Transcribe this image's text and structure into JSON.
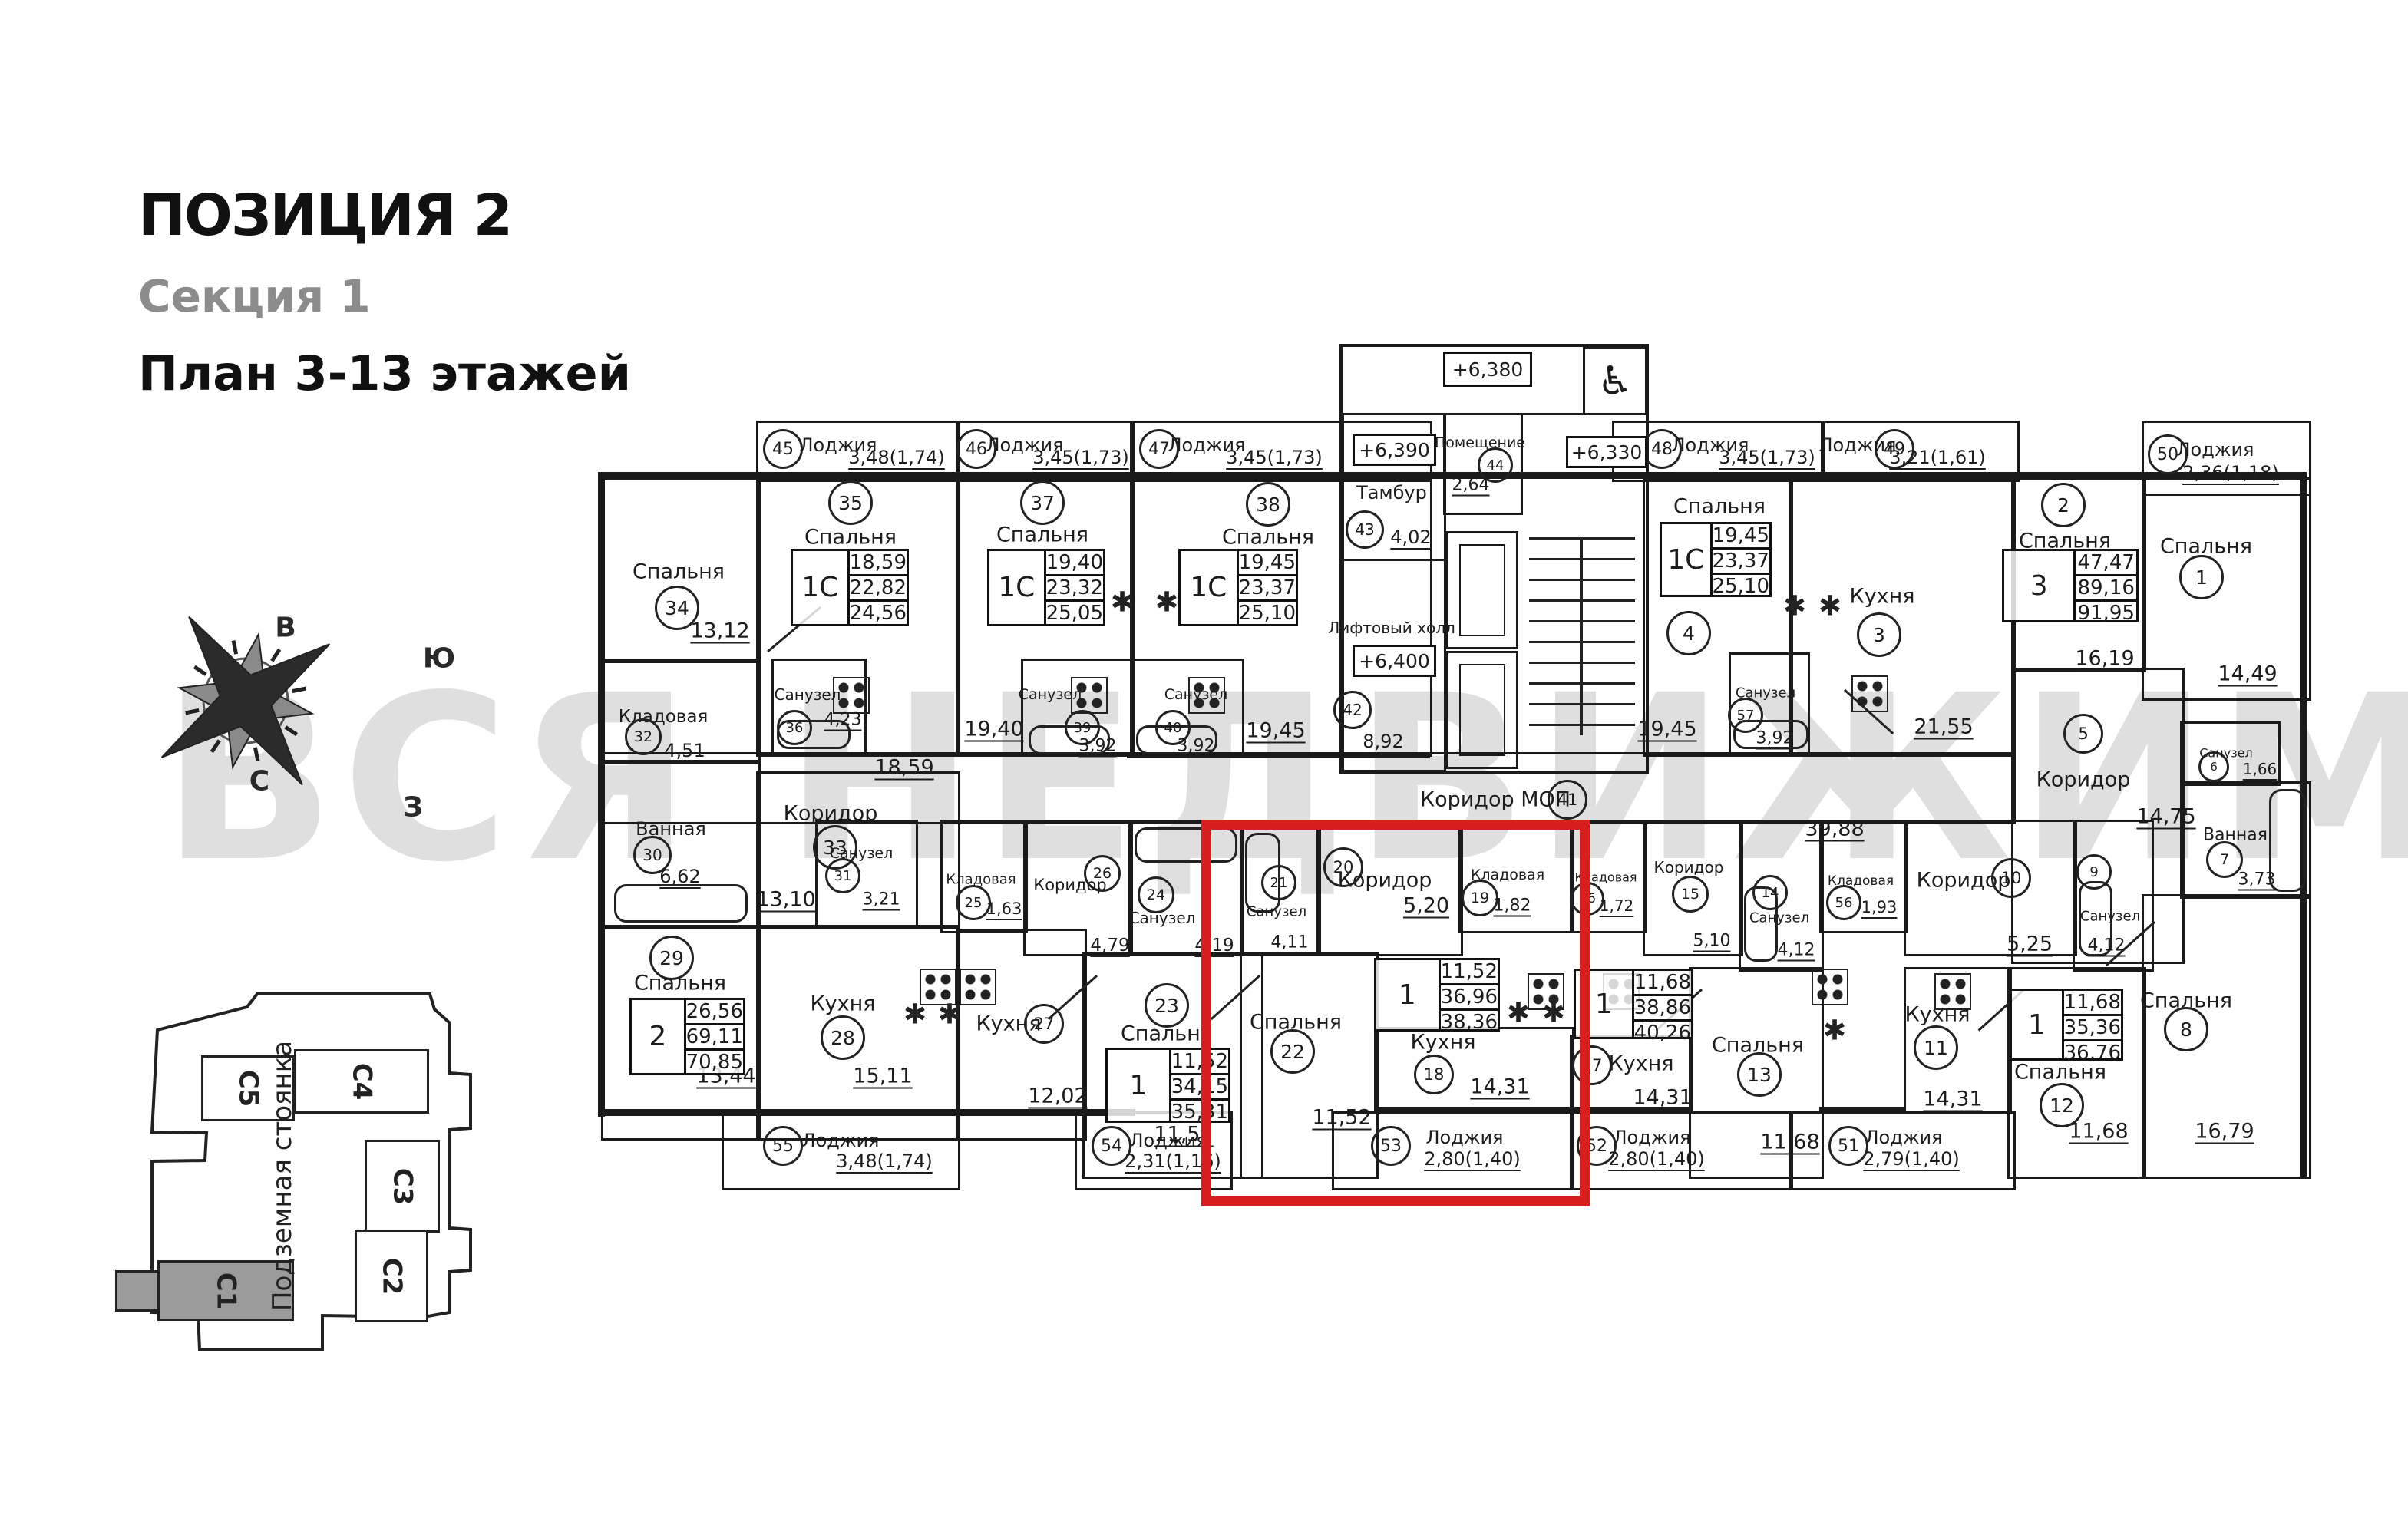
{
  "header": {
    "title": "ПОЗИЦИЯ 2",
    "section": "Секция 1",
    "floors": "План 3-13 этажей"
  },
  "watermark": {
    "text": "ВСЯ НЕДВИЖИМОСТЬ"
  },
  "compass": {
    "east": "В",
    "south": "Ю",
    "north": "С",
    "west": "З"
  },
  "site": {
    "label_line1": "Подземная",
    "label_line2": "стоянка",
    "sections": [
      {
        "name": "С5",
        "highlighted": false
      },
      {
        "name": "С4",
        "highlighted": false
      },
      {
        "name": "С3",
        "highlighted": false
      },
      {
        "name": "С2",
        "highlighted": false
      },
      {
        "name": "С1",
        "highlighted": true
      }
    ]
  },
  "plan": {
    "icons": {
      "vent": "✱",
      "wheelchair": "♿"
    },
    "levels": [
      {
        "id": "lv380",
        "text": "+6,380"
      },
      {
        "id": "lv390",
        "text": "+6,390"
      },
      {
        "id": "lv400",
        "text": "+6,400"
      },
      {
        "id": "lv330",
        "text": "+6,330"
      }
    ],
    "rooms": [
      {
        "id": "r34",
        "label": "Спальня",
        "num": "34",
        "area": "13,12"
      },
      {
        "id": "r35",
        "label": "Спальня",
        "num": "35",
        "area": "18,59"
      },
      {
        "id": "r36",
        "label": "Санузел",
        "num": "36",
        "area": "4,23"
      },
      {
        "id": "r37",
        "label": "Спальня",
        "num": "37",
        "area": "19,40"
      },
      {
        "id": "r39",
        "label": "Санузел",
        "num": "39",
        "area": "3,92"
      },
      {
        "id": "r38",
        "label": "Спальня",
        "num": "38",
        "area": "19,45"
      },
      {
        "id": "r40",
        "label": "Санузел",
        "num": "40",
        "area": "3,92"
      },
      {
        "id": "r43",
        "label": "Тамбур",
        "num": "43",
        "area": "4,02"
      },
      {
        "id": "r44",
        "label": "Помещение",
        "num": "44",
        "area": "2,64"
      },
      {
        "id": "r42",
        "label": "Лифтовый холл",
        "num": "42",
        "area": "8,92"
      },
      {
        "id": "r4",
        "label": "Спальня",
        "num": "4",
        "area": "19,45"
      },
      {
        "id": "r57",
        "label": "Санузел",
        "num": "57",
        "area": "3,92"
      },
      {
        "id": "r3",
        "label": "Кухня",
        "num": "3",
        "area": "21,55"
      },
      {
        "id": "r2",
        "label": "Спальня",
        "num": "2",
        "area": "16,19"
      },
      {
        "id": "r1",
        "label": "Спальня",
        "num": "1",
        "area": "14,49"
      },
      {
        "id": "r41",
        "label": "Коридор МОП",
        "num": "41",
        "area": "39,88"
      },
      {
        "id": "r32",
        "label": "Кладовая",
        "num": "32",
        "area": "4,51"
      },
      {
        "id": "r30",
        "label": "Ванная",
        "num": "30",
        "area": "6,62"
      },
      {
        "id": "r33",
        "label": "Коридор",
        "num": "33",
        "area": "13,10"
      },
      {
        "id": "r31",
        "label": "Санузел",
        "num": "31",
        "area": "3,21"
      },
      {
        "id": "r29",
        "label": "Спальня",
        "num": "29",
        "area": "13,44"
      },
      {
        "id": "r28",
        "label": "Кухня",
        "num": "28",
        "area": "15,11"
      },
      {
        "id": "r25",
        "label": "Кладовая",
        "num": "25",
        "area": "1,63"
      },
      {
        "id": "r26",
        "label": "Коридор",
        "num": "26",
        "area": "4,79"
      },
      {
        "id": "r27",
        "label": "Кухня",
        "num": "27",
        "area": "12,02"
      },
      {
        "id": "r24",
        "label": "Санузел",
        "num": "24",
        "area": "4,19"
      },
      {
        "id": "r23",
        "label": "Спальня",
        "num": "23",
        "area": "11,52"
      },
      {
        "id": "r21",
        "label": "Санузел",
        "num": "21",
        "area": "4,11"
      },
      {
        "id": "r20",
        "label": "Коридор",
        "num": "20",
        "area": "5,20"
      },
      {
        "id": "r19",
        "label": "Кладовая",
        "num": "19",
        "area": "1,82"
      },
      {
        "id": "r22",
        "label": "Спальня",
        "num": "22",
        "area": "11,52"
      },
      {
        "id": "r18",
        "label": "Кухня",
        "num": "18",
        "area": "14,31"
      },
      {
        "id": "r16",
        "label": "Кладовая",
        "num": "16",
        "area": "1,72"
      },
      {
        "id": "r15",
        "label": "Коридор",
        "num": "15",
        "area": "5,10"
      },
      {
        "id": "r14",
        "label": "Санузел",
        "num": "14",
        "area": "4,12"
      },
      {
        "id": "r56",
        "label": "Кладовая",
        "num": "56",
        "area": "1,93"
      },
      {
        "id": "r17",
        "label": "Кухня",
        "num": "17",
        "area": "14,31"
      },
      {
        "id": "r13",
        "label": "Спальня",
        "num": "13",
        "area": "11,68"
      },
      {
        "id": "r10",
        "label": "Коридор",
        "num": "10",
        "area": "5,25"
      },
      {
        "id": "r9",
        "label": "Санузел",
        "num": "9",
        "area": "4,12"
      },
      {
        "id": "r11",
        "label": "Кухня",
        "num": "11",
        "area": "14,31"
      },
      {
        "id": "r12",
        "label": "Спальня",
        "num": "12",
        "area": "11,68"
      },
      {
        "id": "r5",
        "label": "Коридор",
        "num": "5",
        "area": "14,75"
      },
      {
        "id": "r6",
        "label": "Санузел",
        "num": "6",
        "area": "1,66"
      },
      {
        "id": "r7",
        "label": "Ванная",
        "num": "7",
        "area": "3,73"
      },
      {
        "id": "r8",
        "label": "Спальня",
        "num": "8",
        "area": "16,79"
      }
    ],
    "tables": [
      {
        "id": "t35",
        "type": "1С",
        "rows": [
          "18,59",
          "22,82",
          "24,56"
        ]
      },
      {
        "id": "t37",
        "type": "1С",
        "rows": [
          "19,40",
          "23,32",
          "25,05"
        ]
      },
      {
        "id": "t38",
        "type": "1С",
        "rows": [
          "19,45",
          "23,37",
          "25,10"
        ]
      },
      {
        "id": "t4",
        "type": "1С",
        "rows": [
          "19,45",
          "23,37",
          "25,10"
        ]
      },
      {
        "id": "t3",
        "type": "3",
        "rows": [
          "47,47",
          "89,16",
          "91,95"
        ]
      },
      {
        "id": "t29",
        "type": "2",
        "rows": [
          "26,56",
          "69,11",
          "70,85"
        ]
      },
      {
        "id": "t23",
        "type": "1",
        "rows": [
          "11,52",
          "34,15",
          "35,31"
        ]
      },
      {
        "id": "t18",
        "type": "1",
        "rows": [
          "11,52",
          "36,96",
          "38,36"
        ]
      },
      {
        "id": "t17",
        "type": "1",
        "rows": [
          "11,68",
          "38,86",
          "40,26"
        ]
      },
      {
        "id": "t12",
        "type": "1",
        "rows": [
          "11,68",
          "35,36",
          "36,76"
        ]
      }
    ],
    "loggias_top": [
      {
        "num": "45",
        "label": "Лоджия",
        "value": "3,48(1,74)"
      },
      {
        "num": "46",
        "label": "Лоджия",
        "value": "3,45(1,73)"
      },
      {
        "num": "47",
        "label": "Лоджия",
        "value": "3,45(1,73)"
      },
      {
        "num": "48",
        "label": "Лоджия",
        "value": "3,45(1,73)"
      },
      {
        "num": "49",
        "label": "Лоджия",
        "value": "3,21(1,61)"
      },
      {
        "num": "50",
        "label": "Лоджия",
        "value": "2,36(1,18)"
      }
    ],
    "loggias_bottom": [
      {
        "num": "55",
        "label": "Лоджия",
        "value": "3,48(1,74)"
      },
      {
        "num": "54",
        "label": "Лоджия",
        "value": "2,31(1,16)"
      },
      {
        "num": "53",
        "label": "Лоджия",
        "value": "2,80(1,40)"
      },
      {
        "num": "52",
        "label": "Лоджия",
        "value": "2,80(1,40)"
      },
      {
        "num": "51",
        "label": "Лоджия",
        "value": "2,79(1,40)"
      }
    ]
  }
}
